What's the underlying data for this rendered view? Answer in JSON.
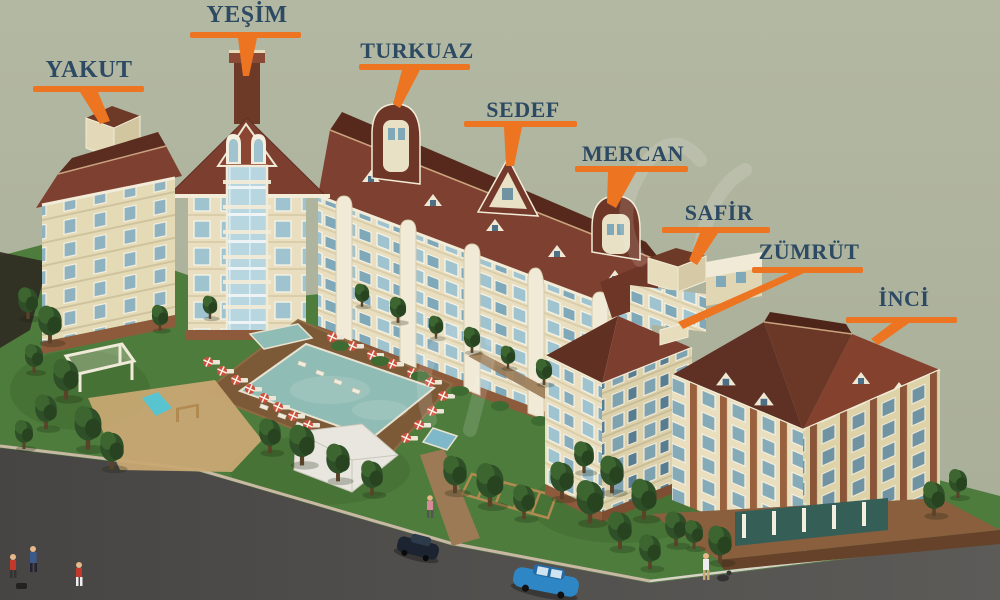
{
  "title": "apartment-complex-site-rendering",
  "labels": [
    {
      "id": "yesim",
      "text": "YEŞİM"
    },
    {
      "id": "yakut",
      "text": "YAKUT"
    },
    {
      "id": "turkuaz",
      "text": "TURKUAZ"
    },
    {
      "id": "sedef",
      "text": "SEDEF"
    },
    {
      "id": "mercan",
      "text": "MERCAN"
    },
    {
      "id": "safir",
      "text": "SAFİR"
    },
    {
      "id": "zumrut",
      "text": "ZÜMRÜT"
    },
    {
      "id": "inci",
      "text": "İNCİ"
    }
  ],
  "colors": {
    "label_text": "#2c4a63",
    "callout_orange": "#ed7420",
    "background_sage": "#afb49e",
    "wall_cream": "#ece3c4",
    "wall_shade": "#dcd2ad",
    "roof_brown": "#7e4030",
    "roof_shade": "#5e2f23",
    "brick_accent": "#99603e",
    "window_blue": "#9fc3cf",
    "grass_green": "#4e7c3d",
    "road_gray": "#4f4d4a",
    "pool_teal": "#8fbcb4",
    "deck_brown": "#7c5a38",
    "sand_tan": "#c8a873"
  }
}
